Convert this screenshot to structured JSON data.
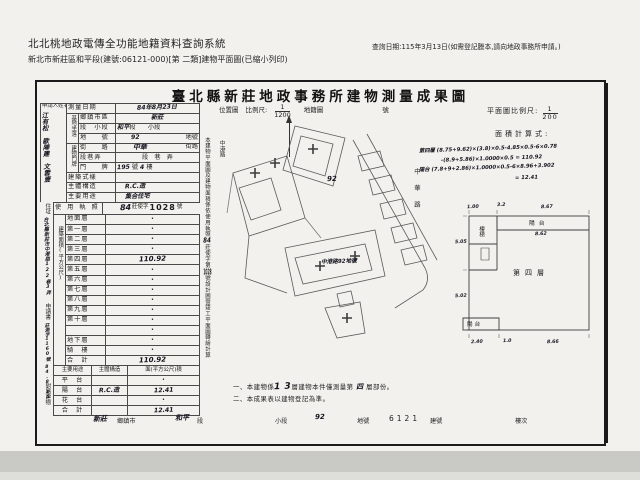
{
  "header": {
    "system_title": "北北桃地政電傳全功能地籍資料查詢系統",
    "query_date": "查詢日期:115年3月13日(如需登記謄本,請向地政事務所申請。)",
    "subtitle": "新北市新莊區和平段(建號:06121-000)[第 二類]建物平面圖(已縮小列印)"
  },
  "form": {
    "title": "臺北縣新莊地政事務所建物測量成果圖",
    "applicant": {
      "label": "申請人姓名",
      "names": "江有松　歐陣建　文雲壹"
    },
    "rows": {
      "survey_date": {
        "label": "測量日期",
        "value": "84年8月23日"
      },
      "site_label": "基地坐落",
      "site_district": {
        "label": "鄉鎮市區",
        "value": "新莊"
      },
      "site_section": {
        "label": "段　小段",
        "value_hand": "和平",
        "value_print": "段　　小段"
      },
      "site_parcel": {
        "label": "地　　號",
        "value_hand": "92",
        "value_print": "地號"
      },
      "plate_label": "建物門牌",
      "plate_street": {
        "label": "街　　路",
        "value_hand": "中華",
        "value_print": "街路"
      },
      "plate_lane": {
        "label": "段巷弄",
        "value_print": "段　巷　弄"
      },
      "plate_number": {
        "label": "門　　牌",
        "value_hand": "195",
        "mid": "號",
        "value_hand2": "4",
        "post": "樓"
      },
      "style": {
        "label": "建築式樣",
        "value": ""
      },
      "structure": {
        "label": "主體構造",
        "value": "R.C.造"
      },
      "usage": {
        "label": "主要用途",
        "value": "集合住宅"
      },
      "license": {
        "label": "使 用 執 照",
        "hand": "84",
        "mid": "莊使字",
        "num": "1028",
        "post": "號"
      }
    },
    "strip": {
      "residence_label": "住址",
      "residence": "台北縣新莊市中港路122巷3弄",
      "application_label": "申請書",
      "application_no": "莊測字1160號",
      "application_date": "84.8.15",
      "attachment_label": "附屬建物"
    },
    "floor_area": {
      "label": "建築面積(平方公尺)",
      "rows": [
        {
          "label": "地面層",
          "value": "•"
        },
        {
          "label": "第一層",
          "value": "•"
        },
        {
          "label": "第二層",
          "value": "•"
        },
        {
          "label": "第三層",
          "value": "•"
        },
        {
          "label": "第四層",
          "value": "110.92"
        },
        {
          "label": "第五層",
          "value": "•"
        },
        {
          "label": "第六層",
          "value": "•"
        },
        {
          "label": "第七層",
          "value": "•"
        },
        {
          "label": "第八層",
          "value": "•"
        },
        {
          "label": "第九層",
          "value": "•"
        },
        {
          "label": "第十層",
          "value": "•"
        },
        {
          "label": "",
          "value": "•"
        },
        {
          "label": "地下層",
          "value": "•"
        },
        {
          "label": "騎　樓",
          "value": "•"
        },
        {
          "label": "合　計",
          "value": "110.92"
        }
      ]
    },
    "attachment": {
      "headers": [
        "主要用途",
        "主體構造",
        "面(平方公尺)積"
      ],
      "rows": [
        {
          "use": "平　台",
          "structure": "",
          "area": "•"
        },
        {
          "use": "陽　台",
          "structure": "R.C.造",
          "area": "12.41"
        },
        {
          "use": "花　台",
          "structure": "",
          "area": "•"
        },
        {
          "use": "合　計",
          "structure": "",
          "area": "12.41"
        }
      ]
    },
    "location_map": {
      "label": "位置圖",
      "scale_label": "比例尺:",
      "scale_num": "1",
      "scale_den": "1200",
      "sheet_label": "地籍圖",
      "number_label": "號",
      "parcel": "92",
      "road_right": "中華路",
      "road_left": "中港路",
      "bottom_label": "中港路92地號"
    },
    "vertical_note": {
      "pre": "本建物平面圖及建物面積係依使用執照",
      "hand1": "84",
      "mid": "莊使字第",
      "hand2": "1028",
      "post": "號設計圖暨竣工平面圖轉繪計算"
    },
    "plan": {
      "scale_label": "平面圖比例尺:",
      "scale_num": "1",
      "scale_den": "200",
      "calc_label": "面積計算式:",
      "calc_lines": [
        "第四層 (8.75+9.62)×(3.8)×0.5-4.85×0.5-6×0.78",
        "-(8.9+5.86)×1.0000×0.5 = 110.92",
        "陽台 (7.8+9+2.86)×1.0000×0.5-6×8.96+3.902",
        "= 12.41"
      ],
      "floor_label": "第四層",
      "balcony_top": "陽台",
      "balcony_top_dim": "8.62",
      "balcony_bottom": "陽台",
      "stair_label": "樓梯",
      "dims": {
        "top1": "1.00",
        "top2": "3.2",
        "top3": "8.67",
        "left1": "5.05",
        "left2": "5.02",
        "bottom1": "2.40",
        "bottom2": "1.0",
        "bottom3": "8.66"
      }
    },
    "notes": {
      "n1_pre": "一、本建物係",
      "n1_hand": "1 3",
      "n1_mid": "層建物本件僅測量第",
      "n1_hand2": "四",
      "n1_post": "層部份。",
      "n2": "二、本成果表以建物登記為準。"
    },
    "footer": {
      "town_v": "新莊",
      "town_l": "鄉鎮市",
      "sec_v": "和平",
      "sec_l": "段",
      "subsec_l": "小段",
      "parcel_v": "92",
      "parcel_l": "地號",
      "bldg_v": "6121",
      "bldg_l": "建號",
      "floor_l": "樓次"
    }
  }
}
